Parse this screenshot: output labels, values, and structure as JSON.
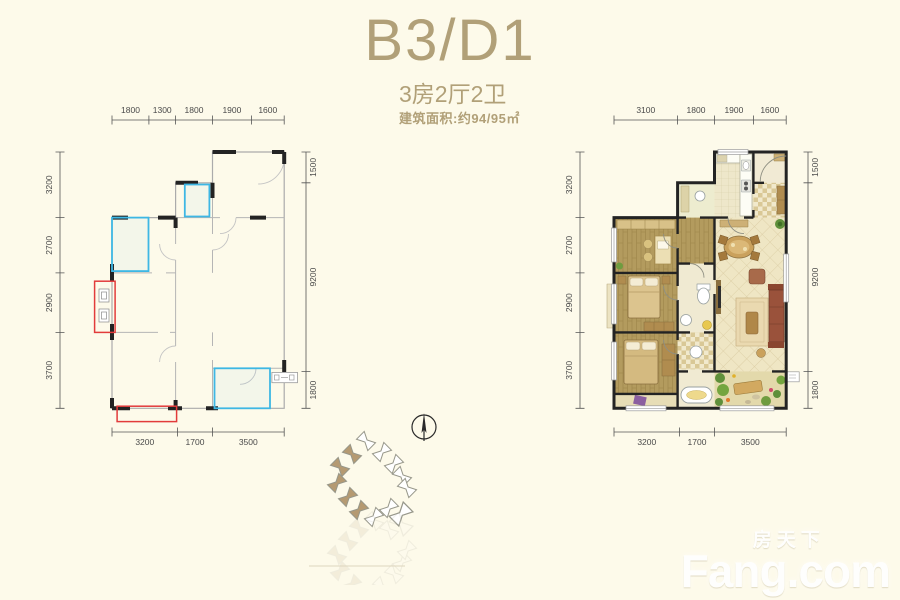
{
  "header": {
    "title": "B3/D1",
    "subtitle": "3房2厅2卫",
    "area_label": "建筑面积:约94/95㎡"
  },
  "left_plan": {
    "dims_top": [
      "1800",
      "1300",
      "1800",
      "1900",
      "1600"
    ],
    "dims_left": [
      "3200",
      "2700",
      "2900",
      "3700"
    ],
    "dims_bottom": [
      "3200",
      "1700",
      "3500"
    ],
    "dims_right": [
      "1500",
      "9200",
      "1800"
    ]
  },
  "right_plan": {
    "dims_top": [
      "3100",
      "1800",
      "1900",
      "1600"
    ],
    "dims_left": [
      "3200",
      "2700",
      "2900",
      "3700"
    ],
    "dims_bottom": [
      "3200",
      "1700",
      "3500"
    ],
    "dims_right": [
      "1500",
      "9200",
      "1800"
    ]
  },
  "watermark": {
    "brand_cn": "房天下",
    "brand_en": "Fang.com"
  },
  "colors": {
    "bg": "#fdfaea",
    "accent": "#b1a078",
    "wall": "#232323",
    "window": "#3db7e4",
    "redmark": "#e23b3b",
    "highlight": "#b59a72",
    "wm": "#ffffff",
    "wood": "#b39b5e",
    "tile": "#efe6c4"
  }
}
